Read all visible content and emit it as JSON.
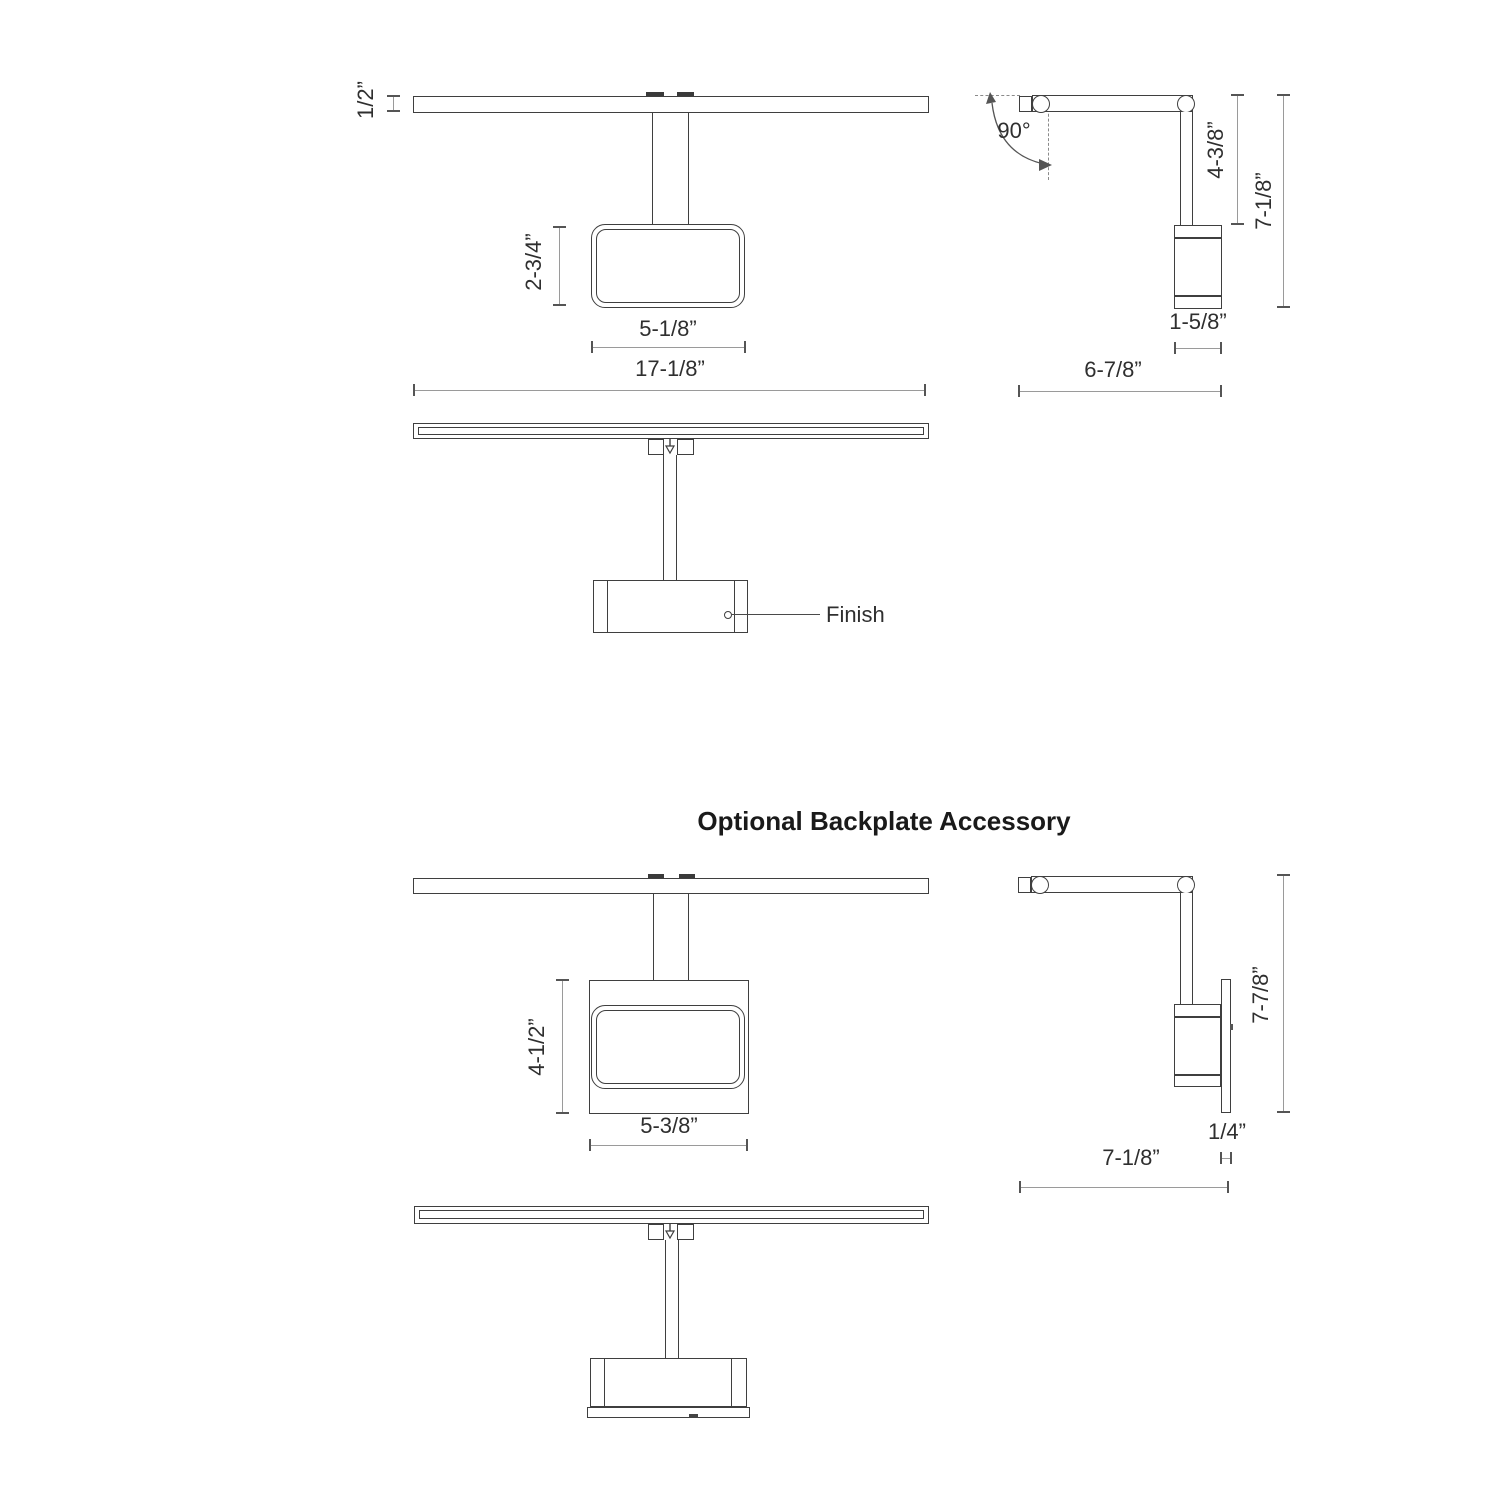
{
  "title": "Optional Backplate Accessory",
  "views": {
    "front_top": {
      "bar_height": "1/2”",
      "head_height": "2-3/4”",
      "head_width": "5-1/8”",
      "overall_width": "17-1/8”"
    },
    "side_top": {
      "angle": "90°",
      "arm_length": "4-3/8”",
      "overall_height": "7-1/8”",
      "body_width": "1-5/8”",
      "overall_depth": "6-7/8”"
    },
    "front_finish": {
      "finish_label": "Finish"
    },
    "front_backplate": {
      "backplate_height": "4-1/2”",
      "backplate_width": "5-3/8”"
    },
    "side_backplate": {
      "overall_height": "7-7/8”",
      "backplate_thickness": "1/4”",
      "overall_depth": "7-1/8”"
    }
  },
  "colors": {
    "line": "#3f3f3f",
    "dim_line": "#9a9a9a",
    "text": "#2f2f2f",
    "background": "#ffffff"
  }
}
